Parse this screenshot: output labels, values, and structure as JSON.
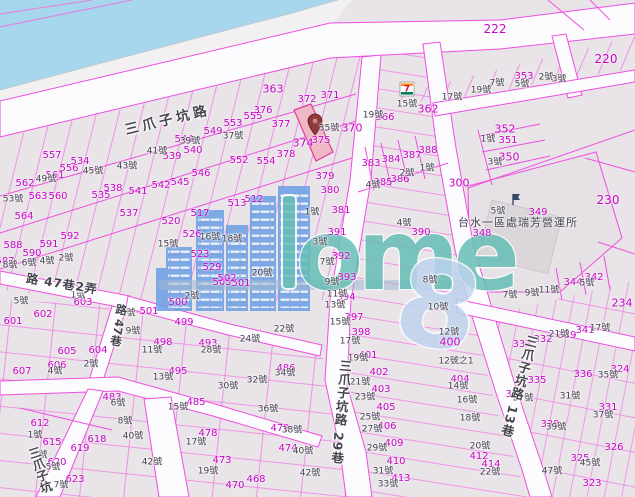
{
  "map": {
    "colors": {
      "water": "#A6D7EC",
      "parcel_fill": "#E9E4E8",
      "boundary_magenta": "#EE4FE0",
      "parcel_label": "#C704C7",
      "house_label": "#3E3E4A",
      "highlight_parcel_fill": "#F0B7C4",
      "road_fill": "#FCFBFD",
      "watermark_blue": "#6FA0E4",
      "watermark_teal": "#66BEB6",
      "watermark_light_blue": "#BED4EE"
    },
    "watermark": {
      "word": "ome",
      "glyph": "8"
    },
    "icons_text": {
      "seven": "7"
    },
    "poi": {
      "label": "台水一區處瑞芳營運所",
      "x": 518,
      "y": 222
    },
    "road_labels": [
      {
        "label": "三爪子坑路",
        "x": 168,
        "y": 121,
        "rot": -13.5,
        "vertical": false,
        "size": 13.5,
        "spacing": 4
      },
      {
        "label": "三爪子坑路 29巷",
        "x": 340,
        "y": 412,
        "rot": 5,
        "vertical": true,
        "size": 12.5,
        "spacing": 1
      },
      {
        "label": "三爪子坑路 13巷",
        "x": 518,
        "y": 386,
        "rot": 15,
        "vertical": true,
        "size": 12.5,
        "spacing": 1
      },
      {
        "label": "路 47巷2弄",
        "x": 62,
        "y": 284,
        "rot": 9,
        "vertical": false,
        "size": 12,
        "spacing": 1
      },
      {
        "label": "路 47巷",
        "x": 118,
        "y": 325,
        "rot": 10,
        "vertical": true,
        "size": 11.5,
        "spacing": 0
      },
      {
        "label": "三爪子坑",
        "x": 40,
        "y": 470,
        "rot": -18,
        "vertical": true,
        "size": 12,
        "spacing": 0
      }
    ],
    "parcel_labels": [
      {
        "t": "557",
        "x": 52,
        "y": 156
      },
      {
        "t": "556",
        "x": 69,
        "y": 169
      },
      {
        "t": "561",
        "x": 55,
        "y": 176
      },
      {
        "t": "534",
        "x": 80,
        "y": 162
      },
      {
        "t": "562",
        "x": 25,
        "y": 184
      },
      {
        "t": "563",
        "x": 38,
        "y": 197
      },
      {
        "t": "560",
        "x": 58,
        "y": 197
      },
      {
        "t": "564",
        "x": 24,
        "y": 217
      },
      {
        "t": "535",
        "x": 101,
        "y": 196
      },
      {
        "t": "538",
        "x": 113,
        "y": 189
      },
      {
        "t": "541",
        "x": 138,
        "y": 192
      },
      {
        "t": "542",
        "x": 161,
        "y": 186
      },
      {
        "t": "545",
        "x": 180,
        "y": 183
      },
      {
        "t": "546",
        "x": 201,
        "y": 174
      },
      {
        "t": "537",
        "x": 129,
        "y": 214
      },
      {
        "t": "544",
        "x": 184,
        "y": 140
      },
      {
        "t": "539",
        "x": 172,
        "y": 157
      },
      {
        "t": "540",
        "x": 193,
        "y": 151
      },
      {
        "t": "549",
        "x": 213,
        "y": 132
      },
      {
        "t": "553",
        "x": 233,
        "y": 124
      },
      {
        "t": "555",
        "x": 253,
        "y": 117
      },
      {
        "t": "552",
        "x": 239,
        "y": 161
      },
      {
        "t": "554",
        "x": 266,
        "y": 162
      },
      {
        "t": "363",
        "x": 273,
        "y": 89,
        "s": 11
      },
      {
        "t": "376",
        "x": 263,
        "y": 111
      },
      {
        "t": "377",
        "x": 281,
        "y": 125
      },
      {
        "t": "374",
        "x": 303,
        "y": 143,
        "s": 11
      },
      {
        "t": "375",
        "x": 321,
        "y": 141
      },
      {
        "t": "372",
        "x": 307,
        "y": 100
      },
      {
        "t": "371",
        "x": 330,
        "y": 96
      },
      {
        "t": "370",
        "x": 352,
        "y": 128,
        "s": 11
      },
      {
        "t": "366",
        "x": 385,
        "y": 118
      },
      {
        "t": "362",
        "x": 428,
        "y": 109,
        "s": 11
      },
      {
        "t": "378",
        "x": 286,
        "y": 155
      },
      {
        "t": "379",
        "x": 325,
        "y": 177
      },
      {
        "t": "380",
        "x": 330,
        "y": 191
      },
      {
        "t": "381",
        "x": 341,
        "y": 211
      },
      {
        "t": "383",
        "x": 371,
        "y": 164
      },
      {
        "t": "384",
        "x": 391,
        "y": 160
      },
      {
        "t": "387",
        "x": 412,
        "y": 156
      },
      {
        "t": "388",
        "x": 428,
        "y": 151
      },
      {
        "t": "385",
        "x": 383,
        "y": 183
      },
      {
        "t": "386",
        "x": 400,
        "y": 180
      },
      {
        "t": "390",
        "x": 421,
        "y": 233
      },
      {
        "t": "391",
        "x": 337,
        "y": 233
      },
      {
        "t": "392",
        "x": 341,
        "y": 257
      },
      {
        "t": "393",
        "x": 347,
        "y": 278
      },
      {
        "t": "394",
        "x": 346,
        "y": 298
      },
      {
        "t": "397",
        "x": 354,
        "y": 318
      },
      {
        "t": "398",
        "x": 361,
        "y": 333
      },
      {
        "t": "401",
        "x": 368,
        "y": 356
      },
      {
        "t": "402",
        "x": 379,
        "y": 373
      },
      {
        "t": "403",
        "x": 381,
        "y": 390
      },
      {
        "t": "405",
        "x": 386,
        "y": 408
      },
      {
        "t": "406",
        "x": 387,
        "y": 427
      },
      {
        "t": "409",
        "x": 394,
        "y": 444
      },
      {
        "t": "410",
        "x": 396,
        "y": 462
      },
      {
        "t": "413",
        "x": 401,
        "y": 479
      },
      {
        "t": "222",
        "x": 495,
        "y": 29,
        "s": 12
      },
      {
        "t": "220",
        "x": 606,
        "y": 59,
        "s": 12
      },
      {
        "t": "230",
        "x": 608,
        "y": 200,
        "s": 12
      },
      {
        "t": "234",
        "x": 622,
        "y": 303,
        "s": 11
      },
      {
        "t": "300",
        "x": 459,
        "y": 183,
        "s": 11
      },
      {
        "t": "353",
        "x": 524,
        "y": 77
      },
      {
        "t": "352",
        "x": 505,
        "y": 129,
        "s": 11
      },
      {
        "t": "351",
        "x": 508,
        "y": 141
      },
      {
        "t": "350",
        "x": 509,
        "y": 157,
        "s": 11
      },
      {
        "t": "349",
        "x": 538,
        "y": 213
      },
      {
        "t": "348",
        "x": 482,
        "y": 234
      },
      {
        "t": "344",
        "x": 573,
        "y": 283
      },
      {
        "t": "342",
        "x": 594,
        "y": 278
      },
      {
        "t": "333",
        "x": 522,
        "y": 345
      },
      {
        "t": "332",
        "x": 543,
        "y": 340
      },
      {
        "t": "339",
        "x": 567,
        "y": 336
      },
      {
        "t": "341",
        "x": 585,
        "y": 331
      },
      {
        "t": "335",
        "x": 537,
        "y": 381
      },
      {
        "t": "336",
        "x": 583,
        "y": 375
      },
      {
        "t": "324",
        "x": 620,
        "y": 370
      },
      {
        "t": "337",
        "x": 515,
        "y": 395
      },
      {
        "t": "331",
        "x": 608,
        "y": 408
      },
      {
        "t": "338",
        "x": 550,
        "y": 425
      },
      {
        "t": "326",
        "x": 614,
        "y": 448
      },
      {
        "t": "325",
        "x": 580,
        "y": 459
      },
      {
        "t": "323",
        "x": 592,
        "y": 484
      },
      {
        "t": "400",
        "x": 450,
        "y": 342,
        "s": 11
      },
      {
        "t": "404",
        "x": 460,
        "y": 380
      },
      {
        "t": "412",
        "x": 479,
        "y": 457
      },
      {
        "t": "414",
        "x": 491,
        "y": 465
      },
      {
        "t": "505",
        "x": 222,
        "y": 283
      },
      {
        "t": "501",
        "x": 241,
        "y": 284
      },
      {
        "t": "502",
        "x": 227,
        "y": 279
      },
      {
        "t": "500",
        "x": 178,
        "y": 303
      },
      {
        "t": "499",
        "x": 184,
        "y": 323
      },
      {
        "t": "501",
        "x": 149,
        "y": 312
      },
      {
        "t": "498",
        "x": 163,
        "y": 343
      },
      {
        "t": "495",
        "x": 178,
        "y": 372
      },
      {
        "t": "493",
        "x": 208,
        "y": 344
      },
      {
        "t": "485",
        "x": 196,
        "y": 403
      },
      {
        "t": "483",
        "x": 112,
        "y": 398
      },
      {
        "t": "486",
        "x": 286,
        "y": 369
      },
      {
        "t": "479",
        "x": 280,
        "y": 429
      },
      {
        "t": "478",
        "x": 208,
        "y": 434
      },
      {
        "t": "474",
        "x": 288,
        "y": 449
      },
      {
        "t": "473",
        "x": 222,
        "y": 461
      },
      {
        "t": "470",
        "x": 235,
        "y": 486
      },
      {
        "t": "468",
        "x": 256,
        "y": 480
      },
      {
        "t": "612",
        "x": 40,
        "y": 424
      },
      {
        "t": "615",
        "x": 52,
        "y": 443
      },
      {
        "t": "618",
        "x": 97,
        "y": 440
      },
      {
        "t": "619",
        "x": 80,
        "y": 449
      },
      {
        "t": "620",
        "x": 57,
        "y": 463
      },
      {
        "t": "623",
        "x": 75,
        "y": 480
      },
      {
        "t": "601",
        "x": 13,
        "y": 322
      },
      {
        "t": "602",
        "x": 43,
        "y": 315
      },
      {
        "t": "603",
        "x": 83,
        "y": 303
      },
      {
        "t": "604",
        "x": 98,
        "y": 351
      },
      {
        "t": "605",
        "x": 67,
        "y": 352
      },
      {
        "t": "606",
        "x": 57,
        "y": 366
      },
      {
        "t": "607",
        "x": 22,
        "y": 372
      },
      {
        "t": "588",
        "x": 13,
        "y": 246
      },
      {
        "t": "587",
        "x": 5,
        "y": 262
      },
      {
        "t": "590",
        "x": 32,
        "y": 254
      },
      {
        "t": "591",
        "x": 49,
        "y": 245
      },
      {
        "t": "592",
        "x": 70,
        "y": 237
      },
      {
        "t": "526",
        "x": 192,
        "y": 235
      },
      {
        "t": "523",
        "x": 200,
        "y": 255
      },
      {
        "t": "529",
        "x": 212,
        "y": 268
      },
      {
        "t": "520",
        "x": 171,
        "y": 222
      },
      {
        "t": "517",
        "x": 200,
        "y": 214
      },
      {
        "t": "513",
        "x": 237,
        "y": 204
      },
      {
        "t": "512",
        "x": 254,
        "y": 200
      }
    ],
    "house_labels": [
      {
        "t": "35號",
        "x": 329,
        "y": 129
      },
      {
        "t": "37號",
        "x": 233,
        "y": 137
      },
      {
        "t": "39號",
        "x": 190,
        "y": 142
      },
      {
        "t": "41號",
        "x": 157,
        "y": 152
      },
      {
        "t": "43號",
        "x": 127,
        "y": 167
      },
      {
        "t": "45號",
        "x": 93,
        "y": 172
      },
      {
        "t": "49號",
        "x": 46,
        "y": 180
      },
      {
        "t": "53號",
        "x": 13,
        "y": 200
      },
      {
        "t": "15號",
        "x": 407,
        "y": 105
      },
      {
        "t": "17號",
        "x": 452,
        "y": 98
      },
      {
        "t": "19號",
        "x": 481,
        "y": 91
      },
      {
        "t": "7號",
        "x": 497,
        "y": 84
      },
      {
        "t": "5號",
        "x": 522,
        "y": 85
      },
      {
        "t": "2號",
        "x": 546,
        "y": 78
      },
      {
        "t": "3號",
        "x": 559,
        "y": 80
      },
      {
        "t": "19號",
        "x": 373,
        "y": 116
      },
      {
        "t": "1號",
        "x": 488,
        "y": 140
      },
      {
        "t": "3號",
        "x": 495,
        "y": 163
      },
      {
        "t": "1號",
        "x": 427,
        "y": 169
      },
      {
        "t": "2號",
        "x": 407,
        "y": 174
      },
      {
        "t": "4號",
        "x": 373,
        "y": 186
      },
      {
        "t": "5號",
        "x": 498,
        "y": 212
      },
      {
        "t": "7號",
        "x": 510,
        "y": 296
      },
      {
        "t": "9號",
        "x": 532,
        "y": 294
      },
      {
        "t": "11號",
        "x": 549,
        "y": 291
      },
      {
        "t": "5號",
        "x": 587,
        "y": 284
      },
      {
        "t": "17號",
        "x": 600,
        "y": 329
      },
      {
        "t": "21號",
        "x": 559,
        "y": 335
      },
      {
        "t": "35號",
        "x": 608,
        "y": 376
      },
      {
        "t": "31號",
        "x": 570,
        "y": 397
      },
      {
        "t": "27號",
        "x": 523,
        "y": 399
      },
      {
        "t": "37號",
        "x": 603,
        "y": 416
      },
      {
        "t": "39號",
        "x": 556,
        "y": 428
      },
      {
        "t": "45號",
        "x": 590,
        "y": 464
      },
      {
        "t": "47號",
        "x": 552,
        "y": 472
      },
      {
        "t": "12號",
        "x": 449,
        "y": 333
      },
      {
        "t": "12號之1",
        "x": 456,
        "y": 362
      },
      {
        "t": "14號",
        "x": 458,
        "y": 387
      },
      {
        "t": "16號",
        "x": 467,
        "y": 401
      },
      {
        "t": "18號",
        "x": 470,
        "y": 419
      },
      {
        "t": "20號",
        "x": 480,
        "y": 447
      },
      {
        "t": "22號",
        "x": 490,
        "y": 473
      },
      {
        "t": "4號",
        "x": 404,
        "y": 224
      },
      {
        "t": "8號",
        "x": 430,
        "y": 281
      },
      {
        "t": "10號",
        "x": 438,
        "y": 308
      },
      {
        "t": "1號",
        "x": 312,
        "y": 213
      },
      {
        "t": "3號",
        "x": 320,
        "y": 243
      },
      {
        "t": "7號",
        "x": 327,
        "y": 263
      },
      {
        "t": "9號",
        "x": 332,
        "y": 283
      },
      {
        "t": "11號",
        "x": 337,
        "y": 295
      },
      {
        "t": "13號",
        "x": 335,
        "y": 306
      },
      {
        "t": "15號",
        "x": 340,
        "y": 323
      },
      {
        "t": "17號",
        "x": 350,
        "y": 342
      },
      {
        "t": "19號",
        "x": 358,
        "y": 359
      },
      {
        "t": "21號",
        "x": 360,
        "y": 383
      },
      {
        "t": "23號",
        "x": 365,
        "y": 398
      },
      {
        "t": "25號",
        "x": 370,
        "y": 418
      },
      {
        "t": "27號",
        "x": 372,
        "y": 430
      },
      {
        "t": "29號",
        "x": 377,
        "y": 449
      },
      {
        "t": "31號",
        "x": 383,
        "y": 472
      },
      {
        "t": "33號",
        "x": 388,
        "y": 485
      },
      {
        "t": "15號",
        "x": 168,
        "y": 245
      },
      {
        "t": "16號",
        "x": 210,
        "y": 238
      },
      {
        "t": "18號",
        "x": 232,
        "y": 240
      },
      {
        "t": "20號",
        "x": 262,
        "y": 274
      },
      {
        "t": "22號",
        "x": 284,
        "y": 330
      },
      {
        "t": "24號",
        "x": 250,
        "y": 340
      },
      {
        "t": "28號",
        "x": 211,
        "y": 351
      },
      {
        "t": "30號",
        "x": 228,
        "y": 387
      },
      {
        "t": "32號",
        "x": 257,
        "y": 381
      },
      {
        "t": "34號",
        "x": 285,
        "y": 374
      },
      {
        "t": "36號",
        "x": 268,
        "y": 410
      },
      {
        "t": "38號",
        "x": 292,
        "y": 431
      },
      {
        "t": "40號",
        "x": 303,
        "y": 452
      },
      {
        "t": "42號",
        "x": 310,
        "y": 474
      },
      {
        "t": "2號",
        "x": 66,
        "y": 259
      },
      {
        "t": "4號",
        "x": 47,
        "y": 262
      },
      {
        "t": "6號",
        "x": 29,
        "y": 264
      },
      {
        "t": "8號",
        "x": 10,
        "y": 266
      },
      {
        "t": "1號",
        "x": 78,
        "y": 296
      },
      {
        "t": "5號",
        "x": 21,
        "y": 302
      },
      {
        "t": "2號",
        "x": 91,
        "y": 365
      },
      {
        "t": "4號",
        "x": 55,
        "y": 372
      },
      {
        "t": "2號",
        "x": 192,
        "y": 297
      },
      {
        "t": "1號",
        "x": 35,
        "y": 436
      },
      {
        "t": "3號",
        "x": 40,
        "y": 456
      },
      {
        "t": "5號",
        "x": 53,
        "y": 468
      },
      {
        "t": "7號",
        "x": 61,
        "y": 486
      },
      {
        "t": "6號",
        "x": 118,
        "y": 404
      },
      {
        "t": "8號",
        "x": 125,
        "y": 422
      },
      {
        "t": "7號",
        "x": 128,
        "y": 314
      },
      {
        "t": "9號",
        "x": 133,
        "y": 332
      },
      {
        "t": "11號",
        "x": 152,
        "y": 351
      },
      {
        "t": "13號",
        "x": 163,
        "y": 378
      },
      {
        "t": "15號",
        "x": 178,
        "y": 408
      },
      {
        "t": "17號",
        "x": 196,
        "y": 443
      },
      {
        "t": "19號",
        "x": 208,
        "y": 472
      },
      {
        "t": "40號",
        "x": 133,
        "y": 437
      },
      {
        "t": "42號",
        "x": 152,
        "y": 463
      }
    ]
  }
}
